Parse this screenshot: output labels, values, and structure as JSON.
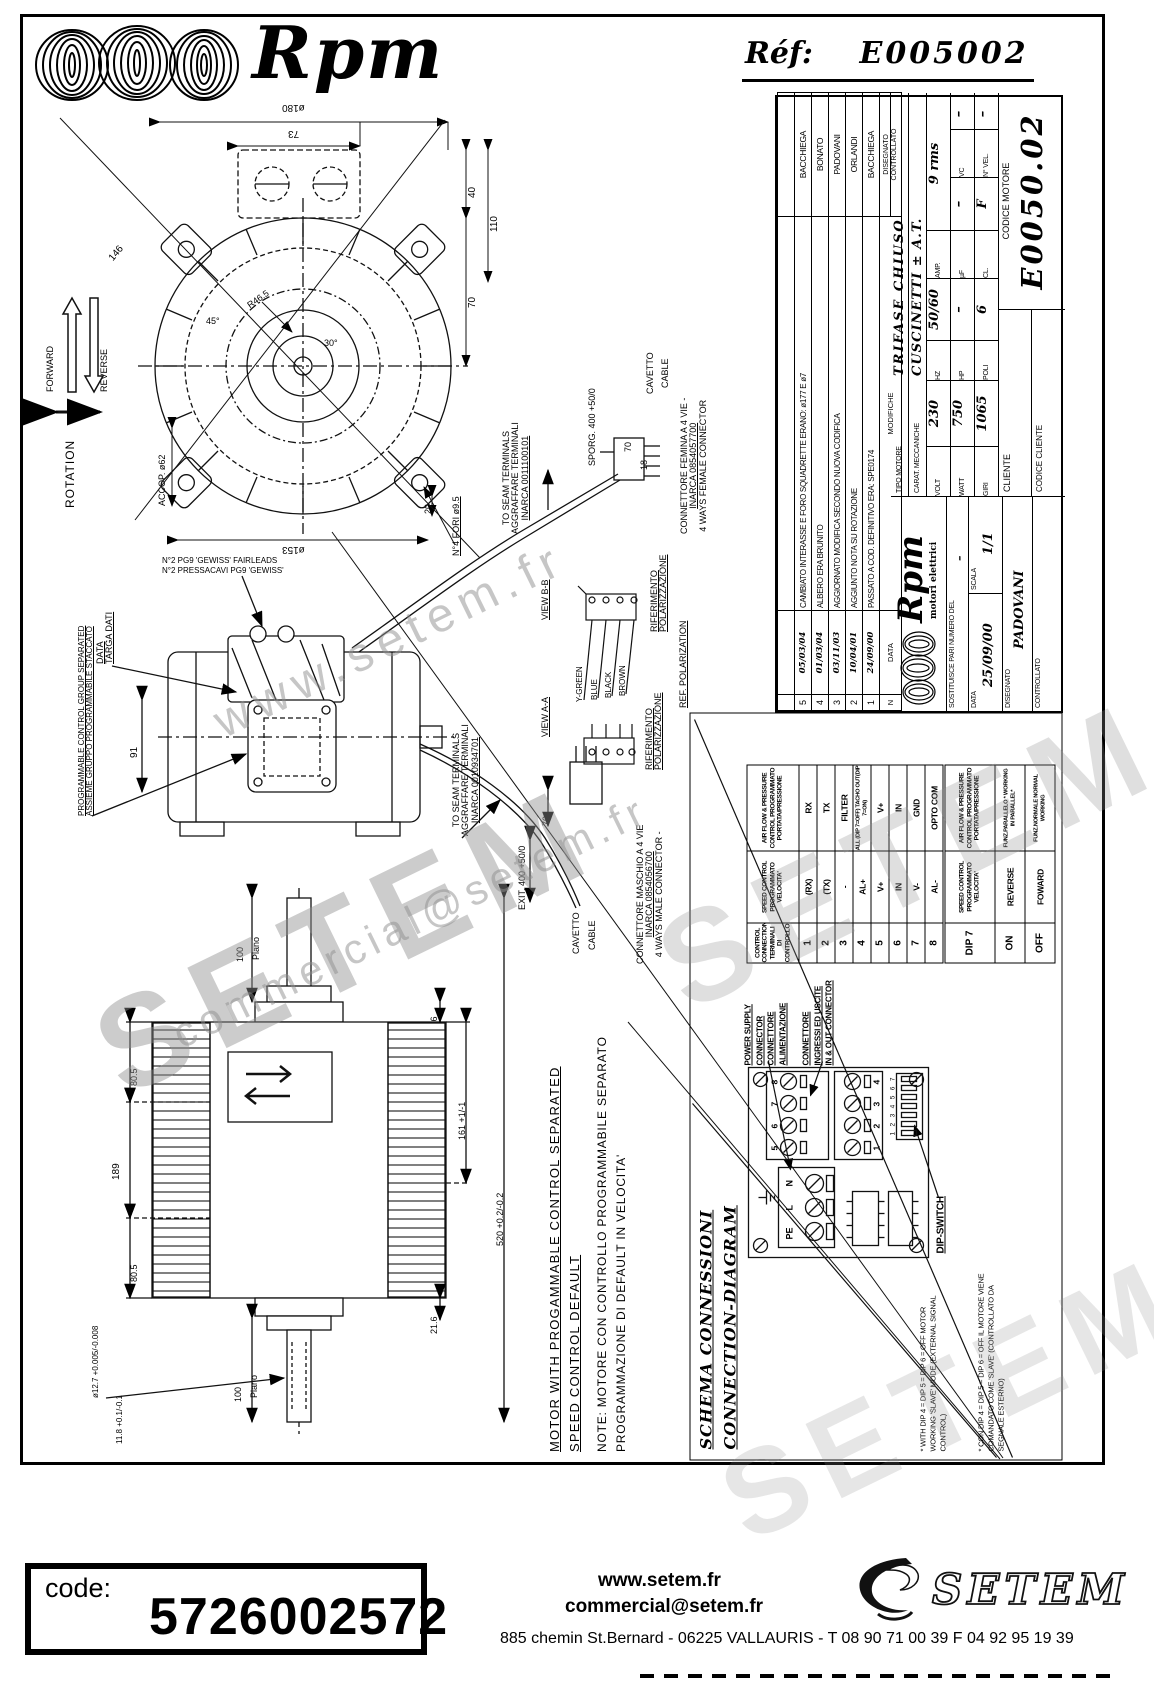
{
  "header": {
    "brand_script": "Rpm",
    "ref_label": "Réf:",
    "ref_value": "E005002"
  },
  "rotation_legend": {
    "title": "ROTATION",
    "forward": "FORWARD",
    "reverse": "REVERSE"
  },
  "front_view": {
    "dia_outer": "ø180",
    "box_width": "73",
    "dim_40": "40",
    "dim_110": "110",
    "dim_70": "70",
    "dim_146": "146",
    "angle_45": "45°",
    "angle_30": "30°",
    "radius": "R46.5",
    "dim_20": "20",
    "accop": "ACCOP. ø62",
    "dia_pitch": "ø153",
    "holes": "N°4 FORI ø9.5"
  },
  "cable_top": {
    "sporg": "SPORG. 400 +50/0",
    "dim_70": "70",
    "dim_18": "18",
    "cavetto": "CAVETTO",
    "cable": "CABLE",
    "seam": [
      "TO SEAM TERMINALS",
      "AGGRAFFARE TERMINALI",
      "INARCA 0011100101"
    ],
    "connector": [
      "CONNETTORE FEMINA A 4 VIE -",
      "INARCA 0854057700",
      "4 WAYS FEMALE CONNECTOR"
    ]
  },
  "views": {
    "view_bb": "VIEW B-B",
    "view_aa": "VIEW A-A",
    "wires": [
      "Y-GREEN",
      "BLUE",
      "BLACK",
      "BROWN"
    ],
    "riferimento": "RIFERIMENTO",
    "polarizzazione": "POLARIZZAZIONE",
    "ref_polarization": "REF. POLARIZATION"
  },
  "side_view_mid": {
    "pressacavi_1": "N°2 PRESSACAVI PG9 'GEWISS'",
    "pressacavi_2": "N°2 PG9 'GEWISS' FAIRLEADS",
    "targa_1": "DATA",
    "targa_2": "TARGA DATI",
    "prog_1": "PROGRAMMABLE CONTROL GROUP SEPARATED",
    "prog_2": "ASSIEME GRUPPO PROGRAMMABILE STACCATO",
    "dim_91": "91"
  },
  "cable_mid": {
    "seam": [
      "TO SEAM TERMINALS",
      "AGGRAFFARE TERMINALI",
      "INARCA 0010934701"
    ],
    "exit": "EXIT. 400 +50/0",
    "dim_70": "70",
    "cavetto": "CAVETTO",
    "cable": "CABLE",
    "connector": [
      "CONNETTORE MASCHIO A 4 VIE",
      "INARCA 0854056700",
      "4 WAYS MALE CONNECTOR -"
    ]
  },
  "side_view_bottom": {
    "dim_100_top": "100",
    "plano_top": "Plano",
    "dim_216_top": "21.6",
    "dim_805_a": "80.5",
    "dim_189": "189",
    "dim_805_b": "80.5",
    "dim_161": "161 +1/-1",
    "dim_520": "520 +0.2/-0.2",
    "dim_216_bot": "21.6",
    "dia_shaft": "ø12.7 +0.005/-0.008",
    "dim_118": "11.8 +0.1/-0.1",
    "dim_100_bot": "100",
    "plano_bot": "Plano",
    "equal": "="
  },
  "note_block": {
    "line1": "MOTOR WITH PROGAMMABLE CONTROL SEPARATED",
    "line2": "SPEED CONTROL DEFAULT",
    "line3": "NOTE: MOTORE CON CONTROLLO PROGRAMMABILE SEPARATO",
    "line4": "PROGRAMMAZIONE DI DEFAULT IN VELOCITA'"
  },
  "title_block": {
    "modifications": {
      "headers": {
        "n": "N",
        "data": "DATA",
        "modifiche": "MODIFICHE",
        "disegnato": "DISEGNATO",
        "controllato": "CONTROLLATO"
      },
      "rows": [
        {
          "n": "5",
          "date": "05/03/04",
          "text": "CAMBIATO INTERASSE E FORO SQUADRETTE ERANO: ø177 E ø7",
          "name": "BACCHIEGA"
        },
        {
          "n": "4",
          "date": "01/03/04",
          "text": "ALBERO ERA BRUNITO",
          "name": "BONATO"
        },
        {
          "n": "3",
          "date": "03/11/03",
          "text": "AGGIORNATO MODIFICA SECONDO NUOVA CODIFICA",
          "name": "PADOVANI"
        },
        {
          "n": "2",
          "date": "10/04/01",
          "text": "AGGIUNTO NOTA SU ROTAZIONE",
          "name": "ORLANDI"
        },
        {
          "n": "1",
          "date": "24/09/00",
          "text": "PASSATO A COD. DEFINITIVO ERA: SPE0174",
          "name": "BACCHIEGA"
        }
      ]
    },
    "tipo_label": "TIPO MOTORE",
    "tipo_value": "TRIFASE CHIUSO",
    "carat_label": "CARAT. MECCANICHE",
    "carat_value": "CUSCINETTI ± A.T.",
    "volt_label": "VOLT",
    "volt_value": "230",
    "hz_label": "HZ",
    "hz_value": "50/60",
    "amp_label": "AMP.",
    "amp_value": "9 rms",
    "watt_label": "WATT",
    "watt_value": "750",
    "hp_label": "HP",
    "hp_value": "–",
    "uf_label": "µF",
    "uf_value": "–",
    "vc_label": "VC",
    "vc_value": "–",
    "giri_label": "GIRI",
    "giri_value": "1065",
    "poli_label": "POLI",
    "poli_value": "6",
    "cl_label": "CL.",
    "cl_value": "F",
    "nvel_label": "N° VEL.",
    "nvel_value": "–",
    "logo_script": "Rpm",
    "logo_sub": "motori elettrici",
    "sostituisce_label": "SOSTITUISCE PARI NUMERO DEL",
    "sostituisce_value": "–",
    "data_label": "DATA",
    "data_value": "25/09/00",
    "scala_label": "SCALA",
    "scala_value": "1/1",
    "disegnato_label": "DISEGNATO",
    "disegnato_value": "PADOVANI",
    "controllato_label": "CONTROLLATO",
    "cliente_label": "CLIENTE",
    "codice_cliente_label": "CODICE CLIENTE",
    "codice_motore_label": "CODICE MOTORE",
    "codice_motore_value": "E0050.02"
  },
  "schema": {
    "title_line1": "SCHEMA CONNESSIONI",
    "title_line2": "CONNECTION-DIAGRAM",
    "table": {
      "col_pin": "CONTROL CONNECTION TERMINALI DI CONTROLLO",
      "col_speed": "SPEED CONTROL PROGRAMMATO VELOCITA'",
      "col_air": "AIR FLOW & PRESSURE CONTROL PROGRAMMATO PORTATA/PRESSIONE",
      "rows": [
        {
          "pin": "1",
          "speed": "(RX)",
          "air": "RX"
        },
        {
          "pin": "2",
          "speed": "(TX)",
          "air": "TX"
        },
        {
          "pin": "3",
          "speed": "-",
          "air": "FILTER"
        },
        {
          "pin": "4",
          "speed": "AL+",
          "air": "ALL (DIP 7=OFF) TACHO OUT(DIP 7=ON)"
        },
        {
          "pin": "5",
          "speed": "V+",
          "air": "V+"
        },
        {
          "pin": "6",
          "speed": "IN",
          "air": "IN"
        },
        {
          "pin": "7",
          "speed": "V-",
          "air": "GND"
        },
        {
          "pin": "8",
          "speed": "AL-",
          "air": "OPTO COM"
        }
      ]
    },
    "dip_table": {
      "header": "DIP 7",
      "col_speed": "SPEED CONTROL PROGRAMMATO VELOCITA'",
      "col_air": "AIR FLOW & PRESSURE CONTROL PROGRAMMATO PORTATA/PRESSIONE",
      "rows": [
        {
          "state": "ON",
          "speed": "REVERSE",
          "air": "FUNZ.PARALLELO * WORKING IN PARALLEL*"
        },
        {
          "state": "OFF",
          "speed": "FOWARD",
          "air": "FUNZ.NORMALE NORMAL WORKING"
        }
      ]
    },
    "pcb": {
      "power_lines": [
        "POWER SUPPLY",
        "CONNECTOR",
        "CONNETTORE",
        "ALIMENTAZIONE"
      ],
      "io_lines": [
        "CONNETTORE",
        "INGRESSI ED USCITE",
        "IN & OUT CONNECTOR"
      ],
      "dip_label": "DIP-SWITCH",
      "power_terminals": [
        "PE",
        "L",
        "N"
      ],
      "io_top": [
        "5",
        "6",
        "7",
        "8"
      ],
      "io_bottom": [
        "1",
        "2",
        "3",
        "4"
      ],
      "dip_numbers": "1234567"
    },
    "notes": [
      "* WITH DIP 4 = DIP 5 = DIP 6 = OFF MOTOR WORKING 'SLAVE' MODE (EXTERNAL SIGNAL CONTROL)",
      "* CON DIP 4 = DIP 5 = DIP 6 = OFF IL MOTORE VIENE COMANDATO COME 'SLAVE' (CONTROLLATO DA SEGNALE ESTERNO)"
    ]
  },
  "watermarks": {
    "w1": "www.setem.fr",
    "w2": "SETEM",
    "w3": "commercial@setem.fr",
    "w4": "SETEM",
    "w5": "SETEM"
  },
  "code_panel": {
    "label": "code:",
    "value": "5726002572"
  },
  "footer": {
    "website": "www.setem.fr",
    "email": "commercial@setem.fr",
    "address": "885 chemin St.Bernard  -  06225 VALLAURIS  -  T 08 90 71 00 39   F 04 92 95 19 39",
    "logo_text": "SETEM"
  }
}
